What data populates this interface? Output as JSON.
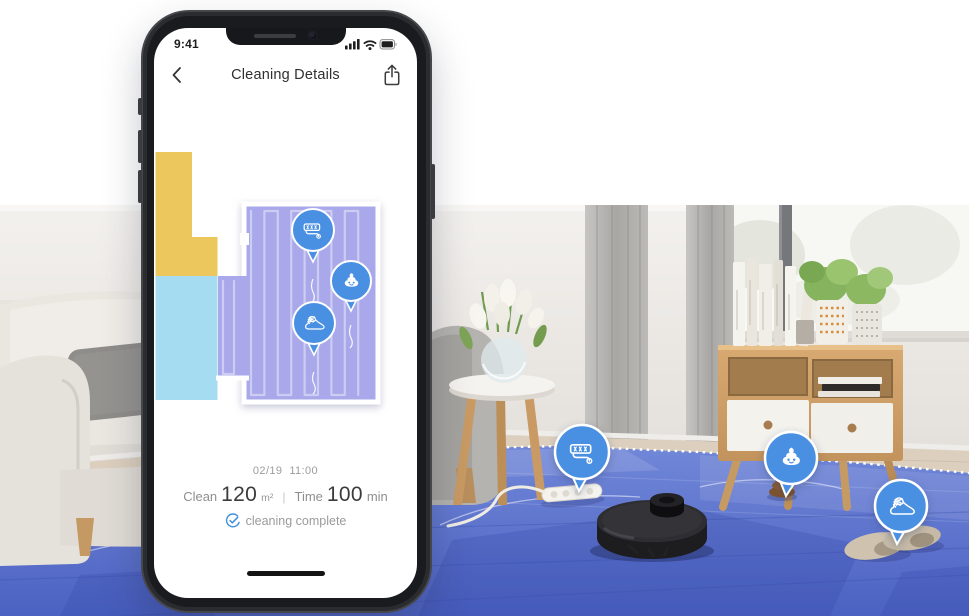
{
  "phone": {
    "status_bar": {
      "time": "9:41"
    },
    "nav": {
      "title": "Cleaning Details"
    },
    "map": {
      "regions": [
        {
          "name": "room-yellow",
          "color": "#ecc75e"
        },
        {
          "name": "room-cyan",
          "color": "#a5dcf2"
        },
        {
          "name": "room-purple",
          "color": "#a9a8ea"
        }
      ],
      "markers": [
        {
          "name": "power-strip",
          "icon": "power-strip-icon"
        },
        {
          "name": "pet-waste",
          "icon": "poop-icon"
        },
        {
          "name": "shoe",
          "icon": "shoe-icon"
        }
      ]
    },
    "summary": {
      "date": "02/19",
      "time": "11:00",
      "clean_label": "Clean",
      "clean_value": "120",
      "clean_unit": "m²",
      "separator": "|",
      "time_label": "Time",
      "time_value": "100",
      "time_unit": "min",
      "status_text": "cleaning complete"
    }
  },
  "scene": {
    "markers": [
      {
        "name": "power-strip",
        "icon": "power-strip-icon"
      },
      {
        "name": "pet-waste",
        "icon": "poop-icon"
      },
      {
        "name": "shoe",
        "icon": "shoe-icon"
      }
    ],
    "colors": {
      "bubble_blue": "#4a90e2",
      "floor_overlay_blue": "#5b74cc",
      "map_purple": "#a9a8ea",
      "map_yellow": "#ecc75e",
      "map_cyan": "#a5dcf2"
    }
  }
}
